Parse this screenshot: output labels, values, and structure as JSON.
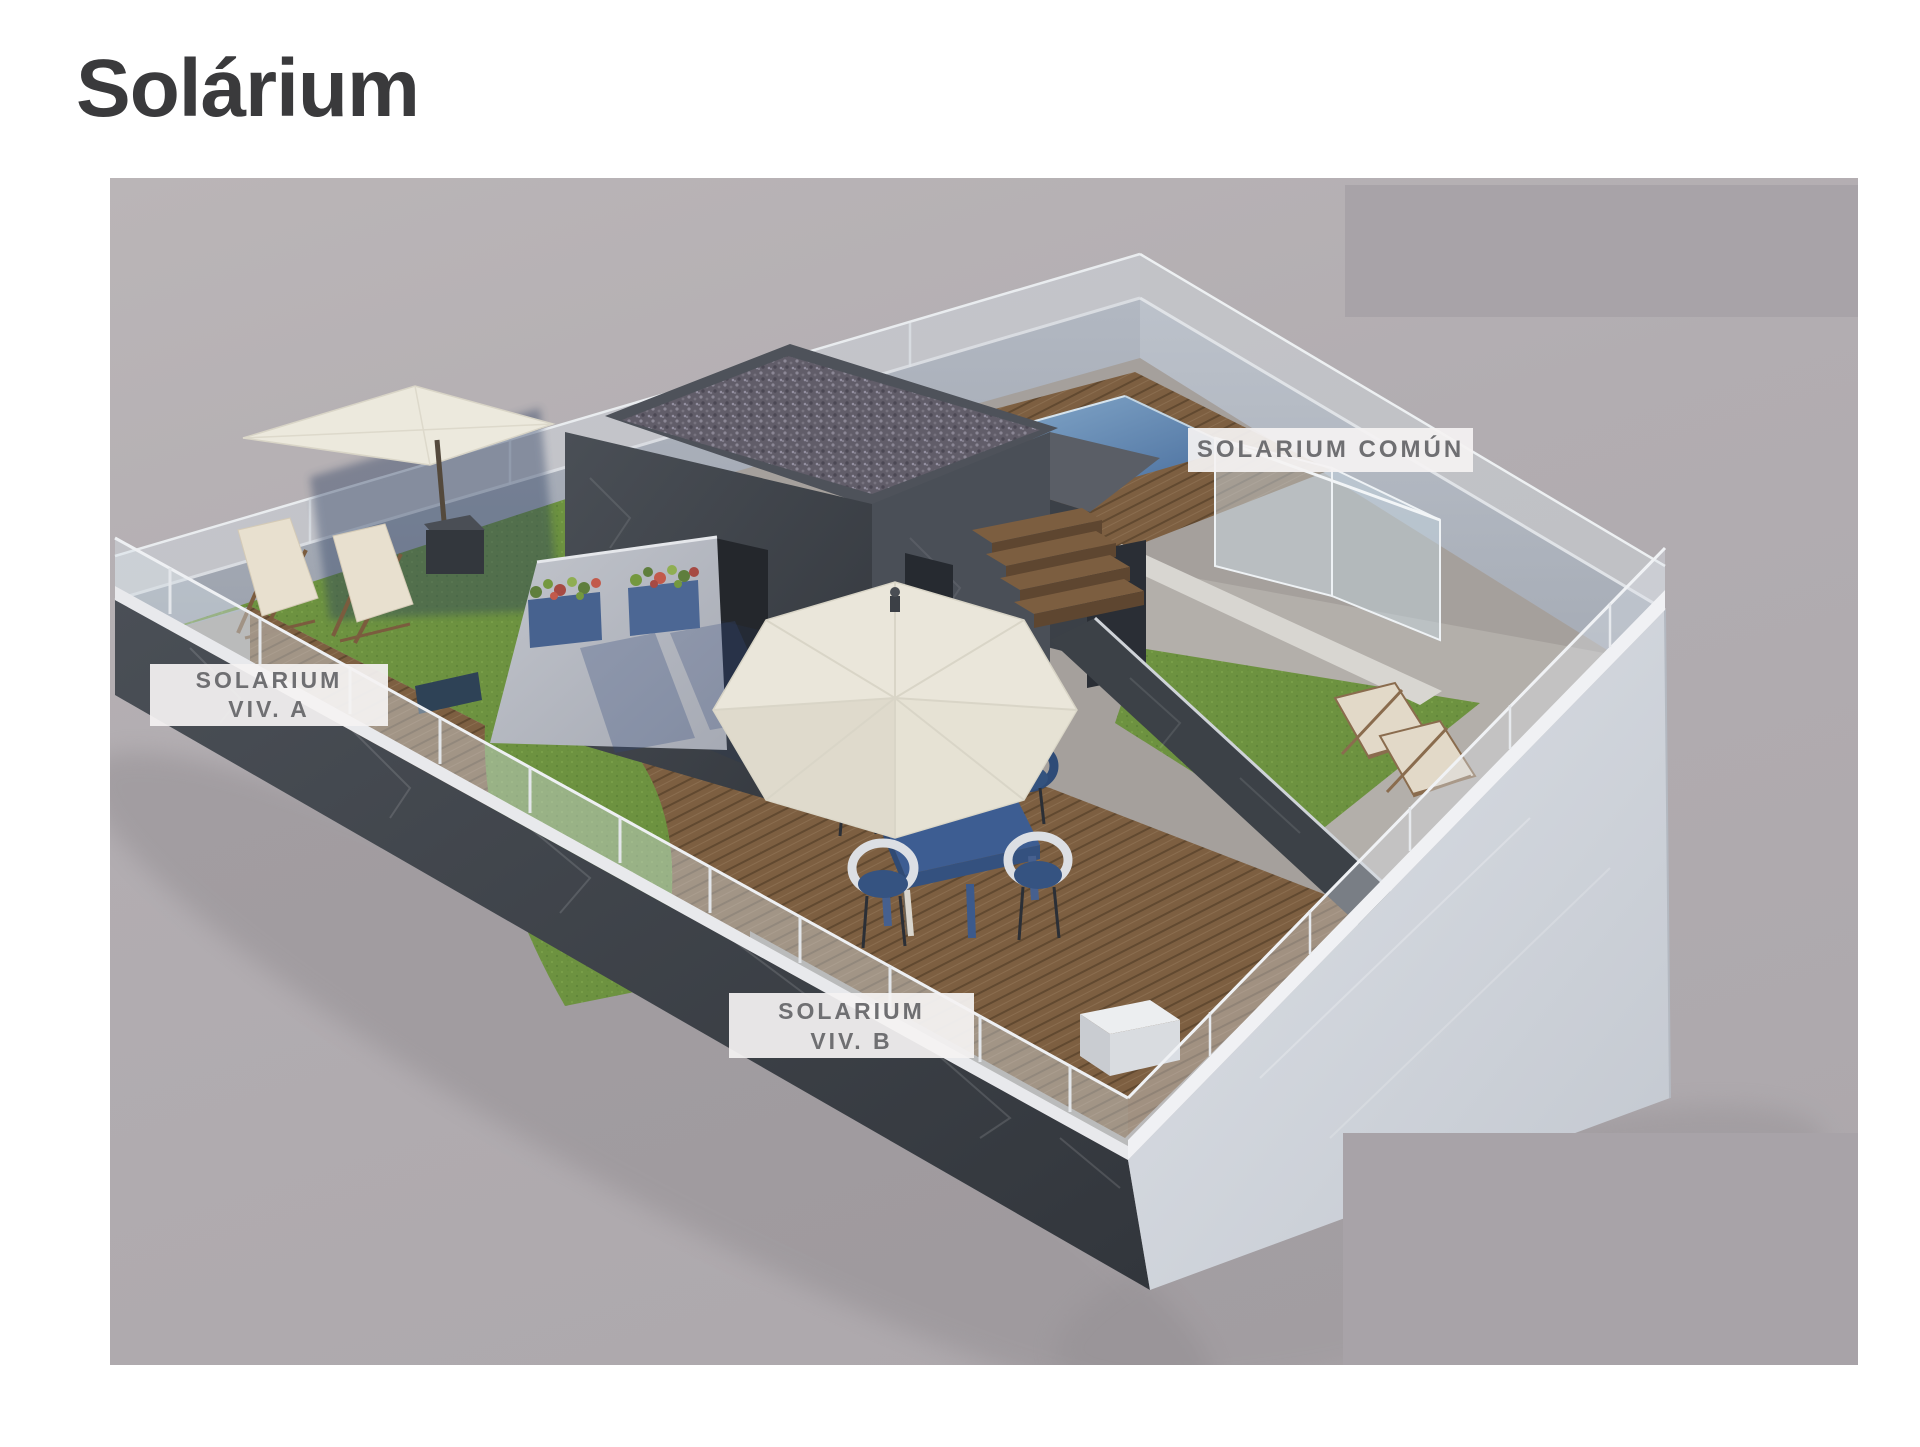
{
  "page": {
    "title": "Solárium",
    "background_color": "#ffffff",
    "title_color": "#3a3a3c"
  },
  "labels": {
    "comun": {
      "text": "SOLARIUM COMÚN"
    },
    "viv_a": {
      "line1": "SOLARIUM",
      "line2": "VIV. A"
    },
    "viv_b": {
      "line1": "SOLARIUM",
      "line2": "VIV. B"
    }
  },
  "scene": {
    "description": "Axonometric 3D render of a rooftop solarium split into three labelled zones",
    "zones": [
      {
        "id": "viv_a",
        "label": "SOLARIUM VIV. A",
        "features": [
          "artificial grass",
          "wood deck",
          "two wooden deck chairs",
          "square cream parasol in planter base"
        ]
      },
      {
        "id": "viv_b",
        "label": "SOLARIUM VIV. B",
        "features": [
          "wood deck",
          "curved grass area",
          "round cream parasol",
          "blue dining table",
          "four wicker chairs",
          "concrete wall with two blue flower planters",
          "white corner planter"
        ]
      },
      {
        "id": "comun",
        "label": "SOLARIUM COMÚN",
        "features": [
          "plunge pool",
          "wood pool deck",
          "wood steps",
          "glass railing",
          "two sun loungers",
          "grass"
        ]
      }
    ],
    "colors": {
      "render_background": "#b2adb1",
      "watermark_block": "#a8a3a8",
      "label_background": "rgba(244,242,242,0.93)",
      "label_text": "#6f6f72",
      "dark_wall": "#3f444b",
      "light_wall": "#d3d7de",
      "inner_wall": "#aeb4bf",
      "wood_deck": "#7d5f41",
      "grass": "#6d9240",
      "pool_water": "#5b82b0",
      "parasol": "#eae6da",
      "planter_blue": "#47628f",
      "gravel_roof": "#67626e",
      "table_blue": "#3d5d92"
    }
  }
}
